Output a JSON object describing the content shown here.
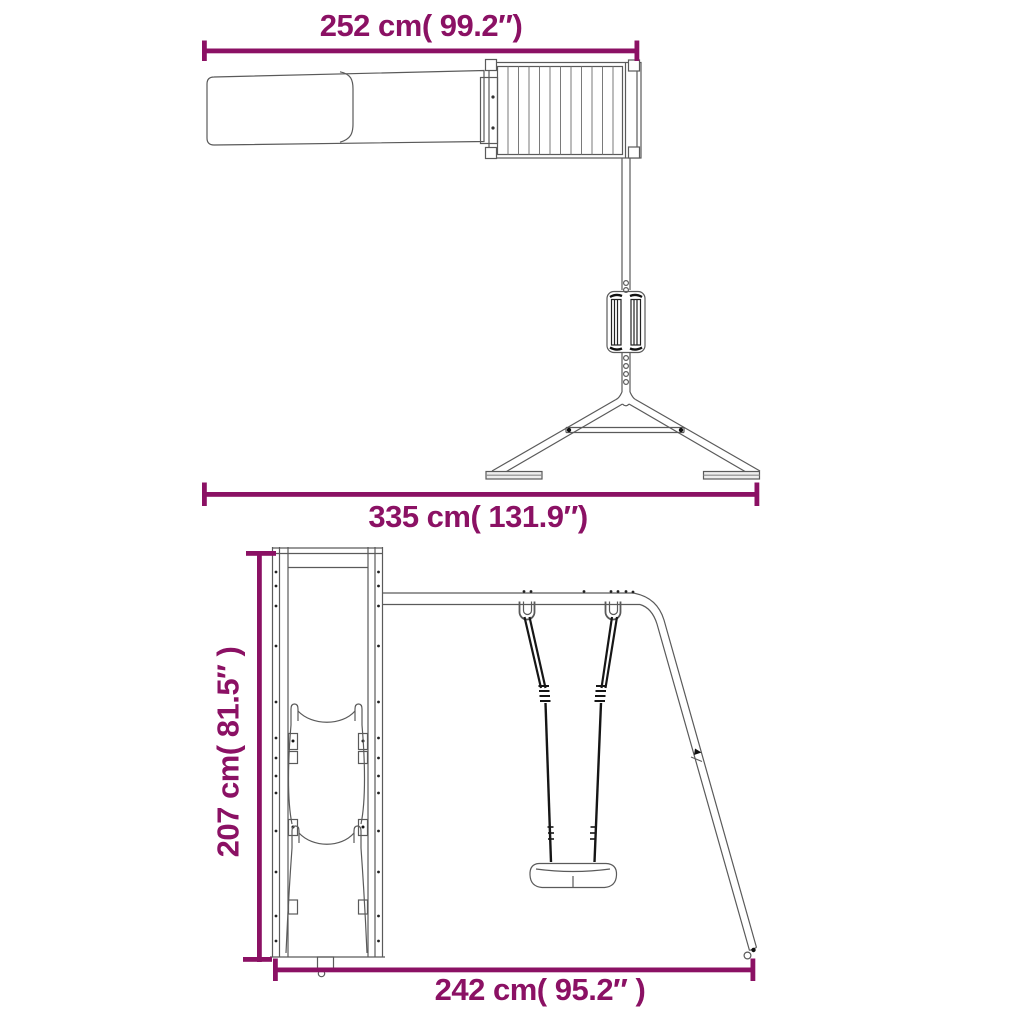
{
  "diagram": {
    "kind": "product-dimension-drawing",
    "subject": "wooden playset with slide, platform and single swing",
    "views": [
      "plan-view",
      "front-view"
    ]
  },
  "dimensions": {
    "depth": {
      "text": "252 cm( 99.2″)",
      "cm": 252,
      "inch": 99.2
    },
    "overall_width": {
      "text": "335 cm( 131.9″)",
      "cm": 335,
      "inch": 131.9
    },
    "height": {
      "text": "207 cm( 81.5″ )",
      "cm": 207,
      "inch": 81.5
    },
    "base_width": {
      "text": "242 cm( 95.2″ )",
      "cm": 242,
      "inch": 95.2
    }
  },
  "colors": {
    "dimension_accent": "#8B1164",
    "drawing_line": "#5a5a5a",
    "rope_black": "#161616",
    "background": "#ffffff"
  }
}
